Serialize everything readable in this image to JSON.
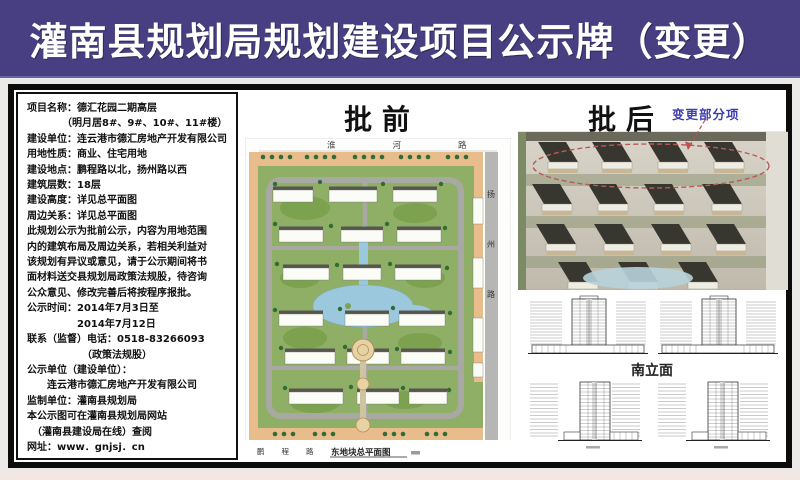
{
  "header": {
    "title": "灌南县规划局规划建设项目公示牌（变更）"
  },
  "info_panel": {
    "lines": [
      "项目名称：德汇花园二期高层",
      "　　　　（明月居8#、9#、10#、11#楼）",
      "建设单位：连云港市德汇房地产开发有限公司",
      "用地性质：商业、住宅用地",
      "建设地点：鹏程路以北，扬州路以西",
      "建筑层数：18层",
      "建设高度：详见总平面图",
      "周边关系：详见总平面图",
      "此规划公示为批前公示，内容为用地范围",
      "内的建筑布局及周边关系，若相关利益对",
      "该规划有异议或意见，请于公示期间将书",
      "面材料送交县规划局政策法规股，待咨询",
      "公众意见、修改完善后将按程序报批。",
      "公示时间：2014年7月3日至",
      "　　　　　2014年7月12日",
      "联系（监督）电话：0518-83266093",
      "　　　　　　（政策法规股）",
      "公示单位（建设单位）：",
      "　　连云港市德汇房地产开发有限公司",
      "监制单位：灌南县规划局",
      "本公示图可在灌南县规划局网站",
      "　（灌南县建设局在线）查阅",
      "网址：www．gnjsj．cn"
    ]
  },
  "before_panel": {
    "title": "批 前",
    "roads": {
      "top": "淮河路",
      "right": "扬州路",
      "bottom": "鹏程路"
    },
    "caption": "东地块总平面图"
  },
  "after_panel": {
    "title": "批 后",
    "annotation": "变更部分项",
    "elevation_caption": "南立面"
  },
  "colors": {
    "header_bg": "#473f82",
    "annotation_text": "#3d3dae",
    "change_outline": "#b85a5a",
    "plan_green": "#8fae66",
    "plan_pond": "#9cc8de",
    "plan_commercial": "#e9bc8c"
  }
}
